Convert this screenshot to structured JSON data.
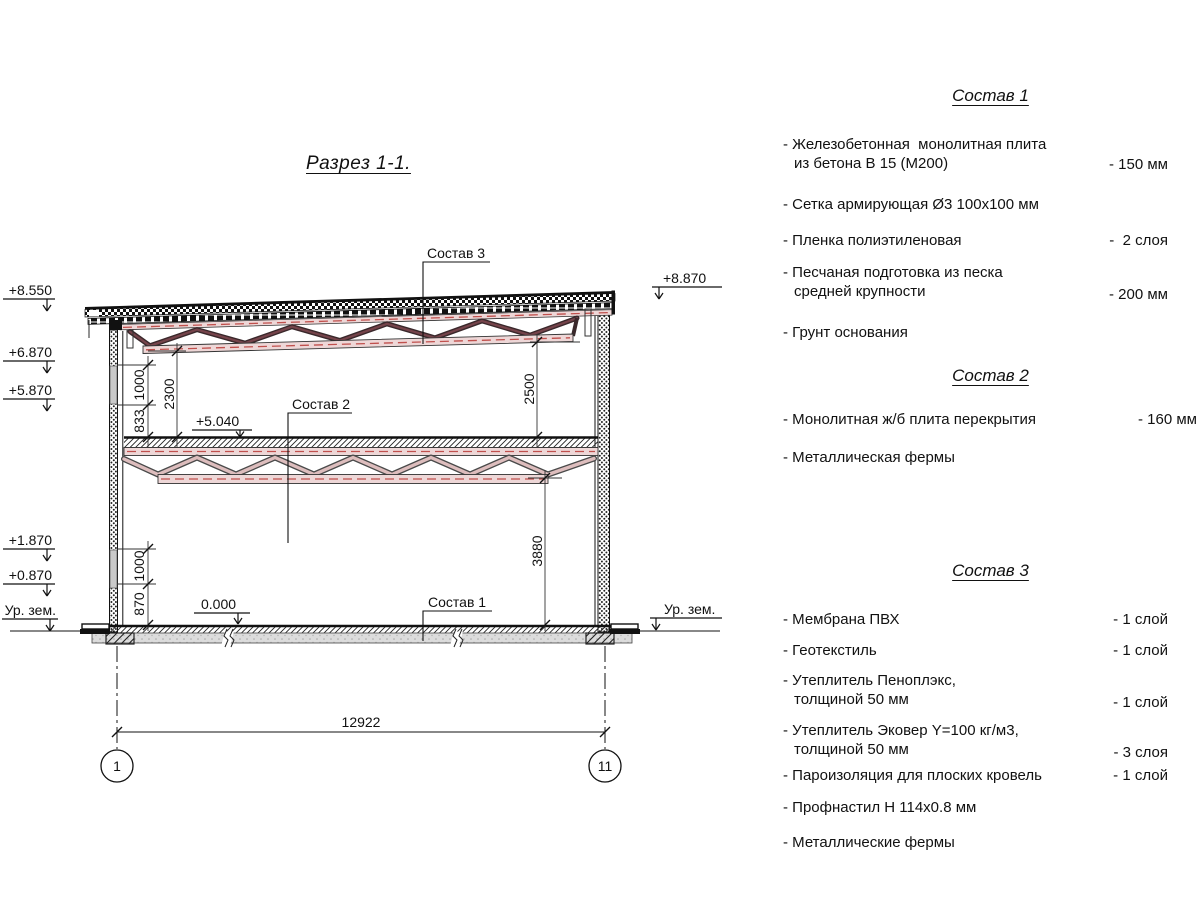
{
  "title": "Разрез 1-1.",
  "drawing": {
    "labels": {
      "s1": "Состав 1",
      "s2": "Состав 2",
      "s3": "Состав 3"
    },
    "elevations": {
      "left": [
        "+8.550",
        "+6.870",
        "+5.870",
        "+1.870",
        "+0.870",
        "Ур. зем."
      ],
      "right_top": "+8.870",
      "right_ground": "Ур. зем.",
      "mid_floor": "+5.040",
      "zero": "0.000"
    },
    "dims": {
      "w1000_top": "1000",
      "w833": "833",
      "h2300": "2300",
      "h2500": "2500",
      "h3880": "3880",
      "w1000_bot": "1000",
      "w870": "870",
      "total": "12922"
    },
    "axes": {
      "left": "1",
      "right": "11"
    }
  },
  "legend": {
    "sections": [
      {
        "heading": "Состав 1",
        "items": [
          {
            "line1": "- Железобетонная  монолитная плита",
            "line2": "из бетона В 15 (М200)",
            "value": "- 150 мм"
          },
          {
            "line1": "- Сетка армирующая Ø3 100x100 мм",
            "line2": "",
            "value": ""
          },
          {
            "line1": "- Пленка полиэтиленовая",
            "line2": "",
            "value": "-  2 слоя"
          },
          {
            "line1": "- Песчаная подготовка из песка",
            "line2": "средней крупности",
            "value": "- 200 мм"
          },
          {
            "line1": "- Грунт основания",
            "line2": "",
            "value": ""
          }
        ]
      },
      {
        "heading": "Состав 2",
        "items": [
          {
            "line1": "- Монолитная ж/б плита перекрытия",
            "line2": "",
            "value": "- 160 мм"
          },
          {
            "line1": "- Металлическая фермы",
            "line2": "",
            "value": ""
          }
        ]
      },
      {
        "heading": "Состав 3",
        "items": [
          {
            "line1": "- Мембрана ПВХ",
            "line2": "",
            "value": "- 1 слой"
          },
          {
            "line1": "- Геотекстиль",
            "line2": "",
            "value": "- 1 слой"
          },
          {
            "line1": "- Утеплитель Пеноплэкс,",
            "line2": "толщиной 50 мм",
            "value": "- 1 слой"
          },
          {
            "line1": "- Утеплитель Эковер Y=100 кг/м3,",
            "line2": "толщиной 50 мм",
            "value": "- 3 слоя"
          },
          {
            "line1": "- Пароизоляция для плоских кровель",
            "line2": "",
            "value": "- 1 слой"
          },
          {
            "line1": "- Профнастил Н 114x0.8 мм",
            "line2": "",
            "value": ""
          },
          {
            "line1": "- Металлические фермы",
            "line2": "",
            "value": ""
          }
        ]
      }
    ]
  },
  "colors": {
    "line": "#111111",
    "truss_dark": "#75434a",
    "truss_light": "#ddbdbd",
    "chord_fill": "#eed7d7",
    "chord_dash": "#c0504d",
    "ground_gray": "#dcdcdc"
  }
}
